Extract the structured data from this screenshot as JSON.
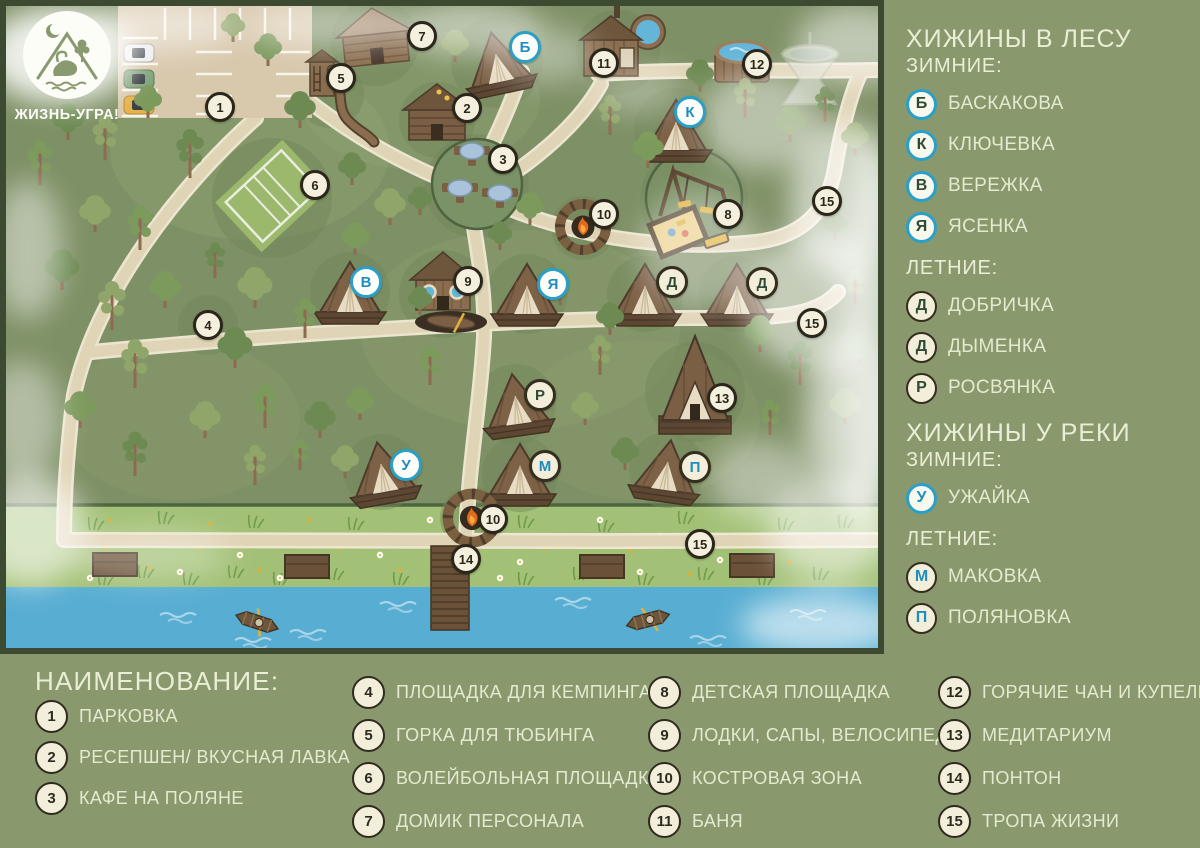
{
  "logo": {
    "brand": "ЖИЗНЬ-УГРА!"
  },
  "sidebar": {
    "sections": [
      {
        "heading": "ХИЖИНЫ В ЛЕСУ",
        "sub": "ЗИМНИЕ:",
        "items": [
          {
            "letter": "Б",
            "name": "БАСКАКОВА",
            "variant": "winter-forest"
          },
          {
            "letter": "К",
            "name": "КЛЮЧЕВКА",
            "variant": "winter-forest"
          },
          {
            "letter": "В",
            "name": "ВЕРЕЖКА",
            "variant": "winter-forest"
          },
          {
            "letter": "Я",
            "name": "ЯСЕНКА",
            "variant": "winter-forest"
          }
        ]
      },
      {
        "heading": "",
        "sub": "ЛЕТНИЕ:",
        "items": [
          {
            "letter": "Д",
            "name": "ДОБРИЧКА",
            "variant": "summer-forest"
          },
          {
            "letter": "Д",
            "name": "ДЫМЕНКА",
            "variant": "summer-forest"
          },
          {
            "letter": "Р",
            "name": "РОСВЯНКА",
            "variant": "summer-forest"
          }
        ]
      },
      {
        "heading": "ХИЖИНЫ У РЕКИ",
        "sub": "ЗИМНИЕ:",
        "items": [
          {
            "letter": "У",
            "name": "УЖАЙКА",
            "variant": "winter-river"
          }
        ]
      },
      {
        "heading": "",
        "sub": "ЛЕТНИЕ:",
        "items": [
          {
            "letter": "М",
            "name": "МАКОВКА",
            "variant": "summer-river"
          },
          {
            "letter": "П",
            "name": "ПОЛЯНОВКА",
            "variant": "summer-river"
          }
        ]
      }
    ]
  },
  "legend": {
    "title": "НАИМЕНОВАНИЕ:",
    "columns": [
      [
        {
          "num": "1",
          "label": "ПАРКОВКА"
        },
        {
          "num": "2",
          "label": "РЕСЕПШЕН/ ВКУСНАЯ ЛАВКА"
        },
        {
          "num": "3",
          "label": "КАФЕ НА ПОЛЯНЕ"
        }
      ],
      [
        {
          "num": "4",
          "label": "ПЛОЩАДКА ДЛЯ КЕМПИНГА"
        },
        {
          "num": "5",
          "label": "ГОРКА ДЛЯ ТЮБИНГА"
        },
        {
          "num": "6",
          "label": "ВОЛЕЙБОЛЬНАЯ ПЛОЩАДКА"
        },
        {
          "num": "7",
          "label": "ДОМИК ПЕРСОНАЛА"
        }
      ],
      [
        {
          "num": "8",
          "label": "ДЕТСКАЯ ПЛОЩАДКА"
        },
        {
          "num": "9",
          "label": "ЛОДКИ, САПЫ, ВЕЛОСИПЕДЫ"
        },
        {
          "num": "10",
          "label": "КОСТРОВАЯ ЗОНА"
        },
        {
          "num": "11",
          "label": "БАНЯ"
        }
      ],
      [
        {
          "num": "12",
          "label": "ГОРЯЧИЕ ЧАН И КУПЕЛЬ"
        },
        {
          "num": "13",
          "label": "МЕДИТАРИУМ"
        },
        {
          "num": "14",
          "label": "ПОНТОН"
        },
        {
          "num": "15",
          "label": "ТРОПА ЖИЗНИ"
        }
      ]
    ]
  },
  "map": {
    "markers": [
      {
        "label": "1",
        "kind": "num",
        "x": 220,
        "y": 107
      },
      {
        "label": "2",
        "kind": "num",
        "x": 467,
        "y": 108
      },
      {
        "label": "3",
        "kind": "num",
        "x": 503,
        "y": 159
      },
      {
        "label": "4",
        "kind": "num",
        "x": 208,
        "y": 325
      },
      {
        "label": "5",
        "kind": "num",
        "x": 341,
        "y": 78
      },
      {
        "label": "6",
        "kind": "num",
        "x": 315,
        "y": 185
      },
      {
        "label": "7",
        "kind": "num",
        "x": 422,
        "y": 36
      },
      {
        "label": "8",
        "kind": "num",
        "x": 728,
        "y": 214
      },
      {
        "label": "9",
        "kind": "num",
        "x": 468,
        "y": 281
      },
      {
        "label": "10",
        "kind": "num",
        "x": 604,
        "y": 214
      },
      {
        "label": "10",
        "kind": "num",
        "x": 493,
        "y": 519
      },
      {
        "label": "11",
        "kind": "num",
        "x": 604,
        "y": 63
      },
      {
        "label": "12",
        "kind": "num",
        "x": 757,
        "y": 64
      },
      {
        "label": "13",
        "kind": "num",
        "x": 722,
        "y": 398
      },
      {
        "label": "14",
        "kind": "num",
        "x": 466,
        "y": 559
      },
      {
        "label": "15",
        "kind": "num",
        "x": 827,
        "y": 201
      },
      {
        "label": "15",
        "kind": "num",
        "x": 812,
        "y": 323
      },
      {
        "label": "15",
        "kind": "num",
        "x": 700,
        "y": 544
      },
      {
        "label": "Б",
        "kind": "winter",
        "x": 525,
        "y": 47
      },
      {
        "label": "К",
        "kind": "winter",
        "x": 690,
        "y": 112
      },
      {
        "label": "В",
        "kind": "winter",
        "x": 366,
        "y": 282
      },
      {
        "label": "Я",
        "kind": "winter",
        "x": 553,
        "y": 284
      },
      {
        "label": "Д",
        "kind": "summer-forest",
        "x": 672,
        "y": 282
      },
      {
        "label": "Д",
        "kind": "summer-forest",
        "x": 762,
        "y": 283
      },
      {
        "label": "Р",
        "kind": "summer-forest",
        "x": 540,
        "y": 395
      },
      {
        "label": "У",
        "kind": "winter",
        "x": 406,
        "y": 465
      },
      {
        "label": "М",
        "kind": "summer-river",
        "x": 545,
        "y": 466
      },
      {
        "label": "П",
        "kind": "summer-river",
        "x": 695,
        "y": 467
      }
    ]
  }
}
